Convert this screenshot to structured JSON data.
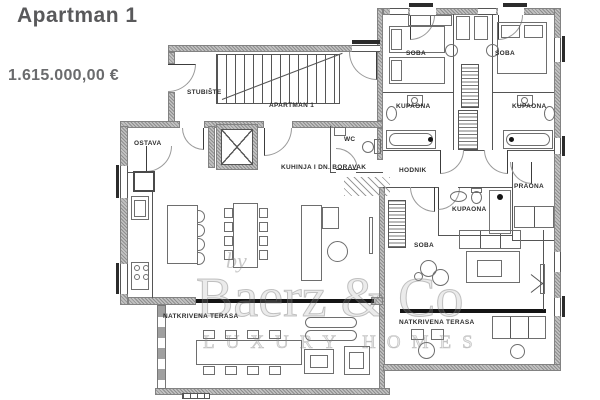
{
  "header": {
    "title": "Apartman 1",
    "price": "1.615.000,00 €"
  },
  "floorplan": {
    "labels": {
      "stubiste": "STUBIŠTE",
      "apartman": "APARTMAN 1",
      "ostava": "OSTAVA",
      "wc": "WC",
      "kuhinja": "KUHINJA I DN. BORAVAK",
      "soba": "SOBA",
      "kupaona": "KUPAONA",
      "hodnik": "HODNIK",
      "praona": "PRAONA",
      "terasa": "NATKRIVENA TERASA"
    }
  },
  "watermark": {
    "prefix": "by",
    "brand": "Baerz & Co",
    "tagline": "LUXURY HOMES"
  },
  "colors": {
    "title": "#59595b",
    "price": "#6a6b6d",
    "wall": "#a9a9a9",
    "line": "#555555",
    "watermark": "#9b9b9b",
    "background": "#ffffff"
  }
}
